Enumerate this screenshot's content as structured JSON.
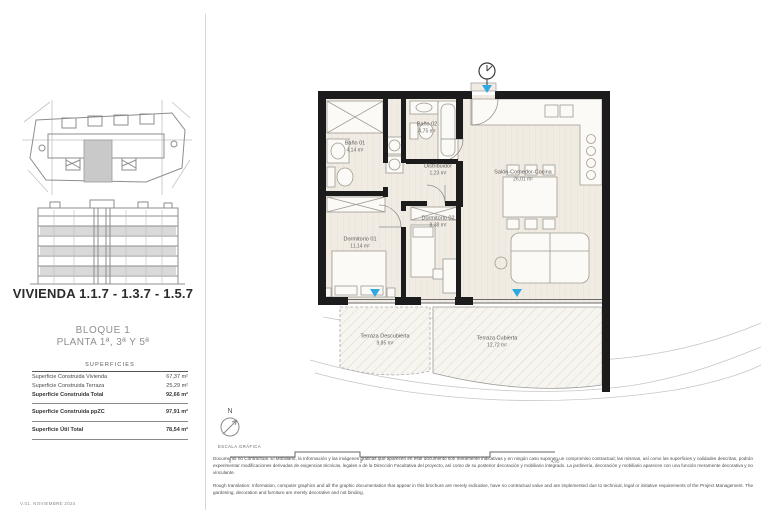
{
  "page": {
    "version_label": "V.01. NOVIEMBRE 2024"
  },
  "sidebar": {
    "title": "VIVIENDA 1.1.7 - 1.3.7 - 1.5.7",
    "block_label": "BLOQUE 1",
    "floor_label": "PLANTA 1ª, 3ª Y 5ª",
    "table": {
      "header": "SUPERFICIES",
      "rows": [
        {
          "label": "Superficie Construida Vivienda",
          "value": "67,37 m²"
        },
        {
          "label": "Superficie Construida Terraza",
          "value": "25,29 m²"
        },
        {
          "label": "Superficie Construida Total",
          "value": "92,66 m²"
        },
        {
          "label": "Superficie Construida ppZC",
          "value": "97,91 m²"
        },
        {
          "label": "Superficie Útil Total",
          "value": "78,54 m²"
        }
      ]
    }
  },
  "plan": {
    "rooms": [
      {
        "name": "Baño 01",
        "area": "4,14 m²"
      },
      {
        "name": "Baño 02",
        "area": "4,75 m²"
      },
      {
        "name": "Distribuidor",
        "area": "1,23 m²"
      },
      {
        "name": "Salón-Comedor-Cocina",
        "area": "26,01 m²"
      },
      {
        "name": "Dormitorio 01",
        "area": "11,14 m²"
      },
      {
        "name": "Dormitorio 02",
        "area": "8,38 m²"
      },
      {
        "name": "Terraza Descubierta",
        "area": "9,85 m²"
      },
      {
        "name": "Terraza Cubierta",
        "area": "12,72 m²"
      }
    ],
    "north_label": "N",
    "scale_label": "ESCALA GRÁFICA",
    "scale_ticks": [
      "0",
      "2",
      "4,95"
    ]
  },
  "footer": {
    "disclaimer_es": "Documento no Contractual. El Mobiliario, la Información y las imágenes gráficas que aparecen en este documento son meramente indicativas y en ningún caso suponen un compromiso contractual; las mismas, así como las superficies y calidades descritas, podrán experimentar modificaciones derivadas de exigencias técnicas, legales o de la Dirección Facultativa del proyecto, así como de su posterior decoración y mobiliario integrado. La jardinería, decoración y mobiliario aparecen con una función meramente decorativa y no vinculante.",
    "disclaimer_en": "Rough translation: Information, computer graphics and all the graphic documentation that appear in this brochure are merely indicative, have no contractual value and are implemented due to technical, legal or initiative requirements of the Project Management. The gardening, decoration and furniture are merely decorative and not binding."
  },
  "colors": {
    "wall": "#1c1c1c",
    "accent_blue": "#2fa8df",
    "highlight_gray": "#c9c9c9",
    "floor_beige": "#f1ece3"
  }
}
